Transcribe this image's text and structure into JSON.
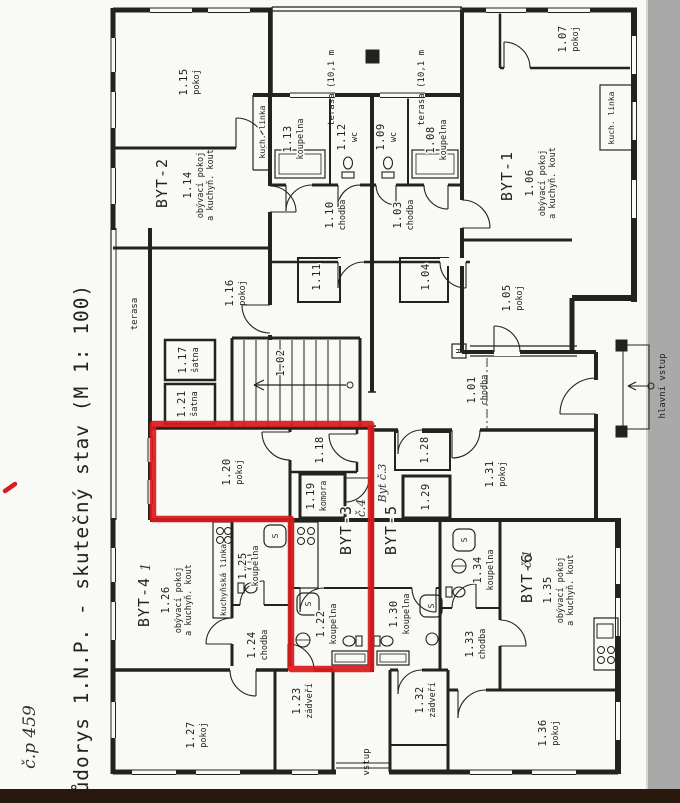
{
  "page": {
    "side_title": "Půdorys 1.N.P. - skutečný stav (M 1: 100)",
    "handwritten_house_number": "č.p 459"
  },
  "apartments": {
    "byt1": {
      "label": "BYT-1"
    },
    "byt2": {
      "label": "BYT-2"
    },
    "byt3": {
      "label": "BYT-3",
      "handwritten_note": "č.4"
    },
    "byt4": {
      "label": "BYT-4",
      "handwritten_note": "1"
    },
    "byt5": {
      "label": "BYT-5",
      "handwritten_note": "Byt č.3"
    },
    "byt6": {
      "label": "BYT-6",
      "handwritten_note": "č.1"
    }
  },
  "rooms": {
    "r101": {
      "number": "1.01",
      "name": "chodba"
    },
    "r102": {
      "number": "1.02"
    },
    "r103": {
      "number": "1.03",
      "name": "chodba"
    },
    "r104": {
      "number": "1.04"
    },
    "r105": {
      "number": "1.05",
      "name": "pokoj"
    },
    "r106": {
      "number": "1.06",
      "name1": "obývací pokoj",
      "name2": "a kuchyň. kout"
    },
    "r107": {
      "number": "1.07",
      "name": "pokoj"
    },
    "r108": {
      "number": "1.08",
      "name": "koupelna"
    },
    "r109": {
      "number": "1.09",
      "name": "wc"
    },
    "r110": {
      "number": "1.10",
      "name": "chodba"
    },
    "r111": {
      "number": "1.11"
    },
    "r112": {
      "number": "1.12",
      "name": "wc"
    },
    "r113": {
      "number": "1.13",
      "name": "koupelna"
    },
    "r114": {
      "number": "1.14",
      "name1": "obývací pokoj",
      "name2": "a kuchyň. kout"
    },
    "r115": {
      "number": "1.15",
      "name": "pokoj"
    },
    "r116": {
      "number": "1.16",
      "name": "pokoj"
    },
    "r117": {
      "number": "1.17",
      "name": "šatna"
    },
    "r118": {
      "number": "1.18"
    },
    "r119": {
      "number": "1.19",
      "name": "komora"
    },
    "r120": {
      "number": "1.20",
      "name": "pokoj"
    },
    "r121": {
      "number": "1.21",
      "name": "šatna"
    },
    "r122": {
      "number": "1.22",
      "name": "koupelna"
    },
    "r123": {
      "number": "1.23",
      "name": "zádveří"
    },
    "r124": {
      "number": "1.24",
      "name": "chodba"
    },
    "r125": {
      "number": "1.25",
      "name": "koupelna"
    },
    "r126": {
      "number": "1.26",
      "name1": "obývací pokoj",
      "name2": "a kuchyň. kout"
    },
    "r127": {
      "number": "1.27",
      "name": "pokoj"
    },
    "r128": {
      "number": "1.28"
    },
    "r129": {
      "number": "1.29"
    },
    "r130": {
      "number": "1.30",
      "name": "koupelna"
    },
    "r131": {
      "number": "1.31",
      "name": "pokoj"
    },
    "r132": {
      "number": "1.32",
      "name": "zádveří"
    },
    "r133": {
      "number": "1.33",
      "name": "chodba"
    },
    "r134": {
      "number": "1.34",
      "name": "koupelna"
    },
    "r135": {
      "number": "1.35",
      "name1": "obývací pokoj",
      "name2": "a kuchyň. kout"
    },
    "r136": {
      "number": "1.36",
      "name": "pokoj"
    }
  },
  "annotations": {
    "terasa_left": "terasa",
    "terasa_top_left": "terasa (10,1 m",
    "terasa_top_right": "terasa (10,1 m",
    "kuch_linka_a": "kuch. linka",
    "kuch_linka_b": "kuch. linka",
    "kuchynska_linka": "kuchyňská linka",
    "hlavni_vstup": "hlavní vstup",
    "vstup": "vstup",
    "hydrant": "H",
    "shower": "S"
  },
  "colors": {
    "highlight_red": "#da1b1b",
    "ink": "#23221f",
    "paper": "#f9f9f6",
    "scanner_grey": "#a9a9a9",
    "scanner_dark": "#27190e"
  }
}
